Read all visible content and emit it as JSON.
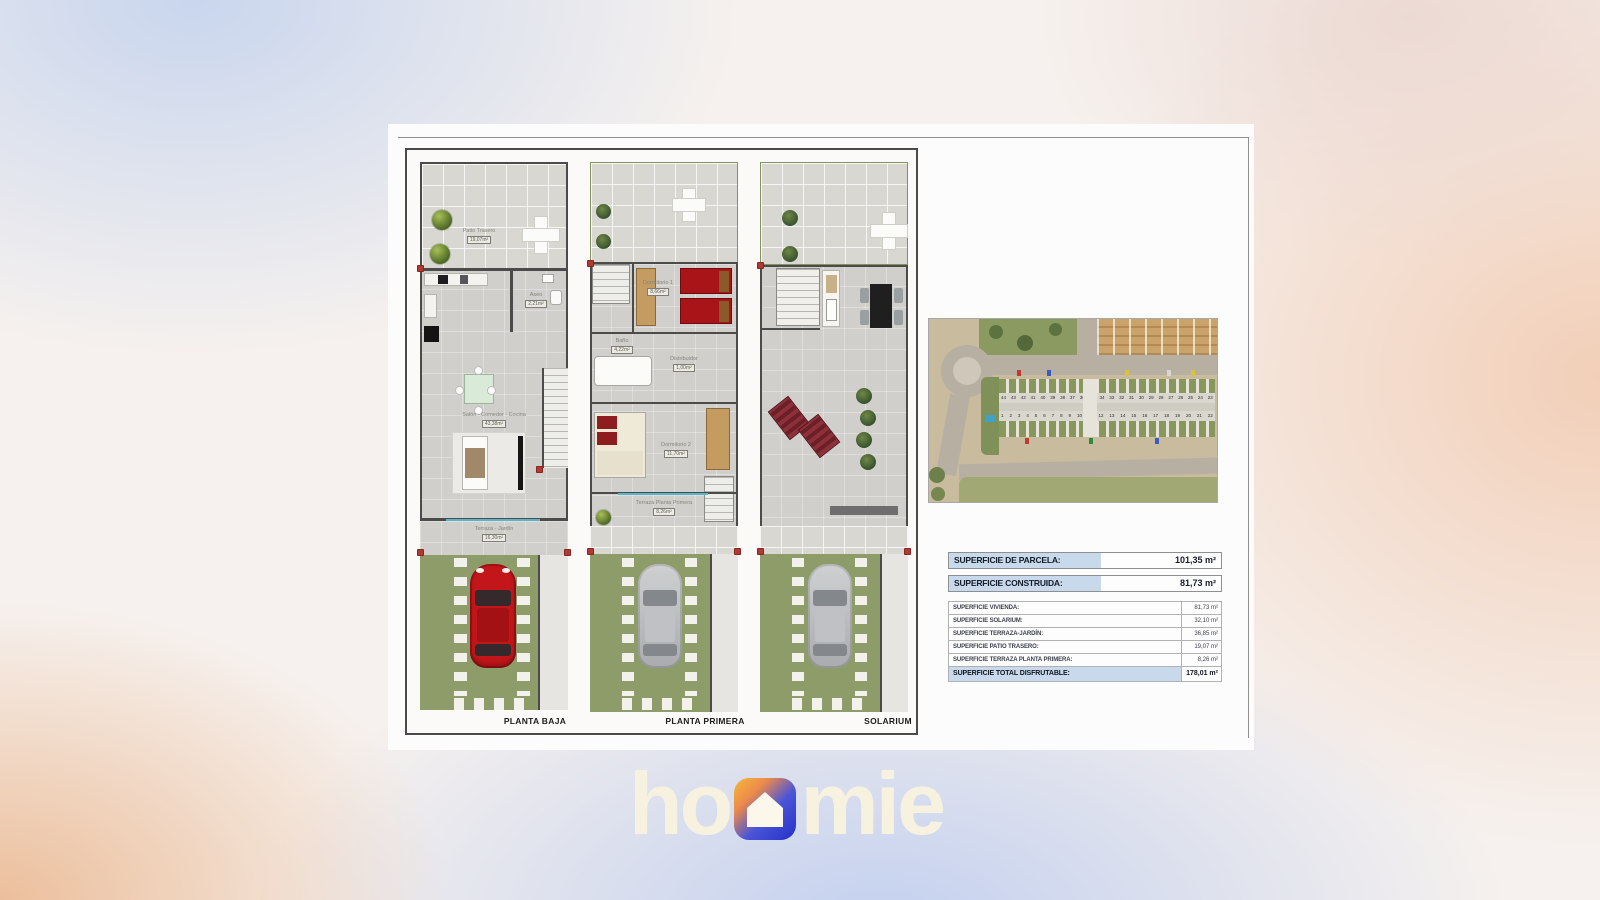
{
  "brand": {
    "part1": "ho",
    "part2": "mie",
    "icon": "house-icon",
    "colors": {
      "text_cream": "#f7f2e0",
      "icon_orange": "#f6b83c",
      "icon_blue": "#2537d8"
    }
  },
  "plans": {
    "planta_baja": {
      "title": "PLANTA BAJA",
      "rooms": {
        "patio": {
          "name": "Patio Trasero",
          "area": "19,07m²"
        },
        "aseo": {
          "name": "Aseo",
          "area": "2,21m²"
        },
        "salon": {
          "name": "Salón - Comedor - Cocina",
          "area": "43,38m²"
        },
        "terraza": {
          "name": "Terraza - Jardín",
          "area": "16,30m²"
        }
      }
    },
    "planta_primera": {
      "title": "PLANTA PRIMERA",
      "rooms": {
        "dormitorio1": {
          "name": "Dormitorio 1",
          "area": "8,66m²"
        },
        "bano": {
          "name": "Baño",
          "area": "4,22m²"
        },
        "distribuidor": {
          "name": "Distribuidor",
          "area": "1,00m²"
        },
        "dormitorio2": {
          "name": "Dormitorio 2",
          "area": "11,70m²"
        },
        "terraza": {
          "name": "Terraza Planta Primera",
          "area": "8,26m²"
        }
      }
    },
    "solarium": {
      "title": "SOLARIUM"
    }
  },
  "site_plan": {
    "row_top": [
      "44",
      "43",
      "42",
      "41",
      "40",
      "39",
      "38",
      "37",
      "36",
      "35",
      "34",
      "33",
      "32",
      "31",
      "30",
      "29",
      "28",
      "27",
      "26",
      "25",
      "24",
      "23"
    ],
    "row_bottom": [
      "1",
      "2",
      "3",
      "4",
      "5",
      "6",
      "7",
      "8",
      "9",
      "10",
      "11",
      "12",
      "13",
      "14",
      "15",
      "16",
      "17",
      "18",
      "19",
      "20",
      "21",
      "22"
    ]
  },
  "surface_table": {
    "primary_rows": [
      {
        "label": "SUPERFICIE DE PARCELA:",
        "value": "101,35 m²"
      },
      {
        "label": "SUPERFICIE CONSTRUIDA:",
        "value": "81,73 m²"
      }
    ],
    "detail_rows": [
      {
        "label": "SUPERFICIE VIVIENDA:",
        "value": "81,73 m²"
      },
      {
        "label": "SUPERFICIE SOLARIUM:",
        "value": "32,10 m²"
      },
      {
        "label": "SUPERFICIE TERRAZA-JARDÍN:",
        "value": "36,85 m²"
      },
      {
        "label": "SUPERFICIE PATIO TRASERO:",
        "value": "19,07 m²"
      },
      {
        "label": "SUPERFICIE TERRAZA PLANTA PRIMERA:",
        "value": "8,26 m²"
      },
      {
        "label": "SUPERFICIE TOTAL DISFRUTABLE:",
        "value": "178,01 m²"
      }
    ]
  },
  "colors": {
    "wall": "#4b4b4b",
    "grass": "#8d9c68",
    "car_red": "#c3161b",
    "table_accent": "#c7d9ea"
  }
}
